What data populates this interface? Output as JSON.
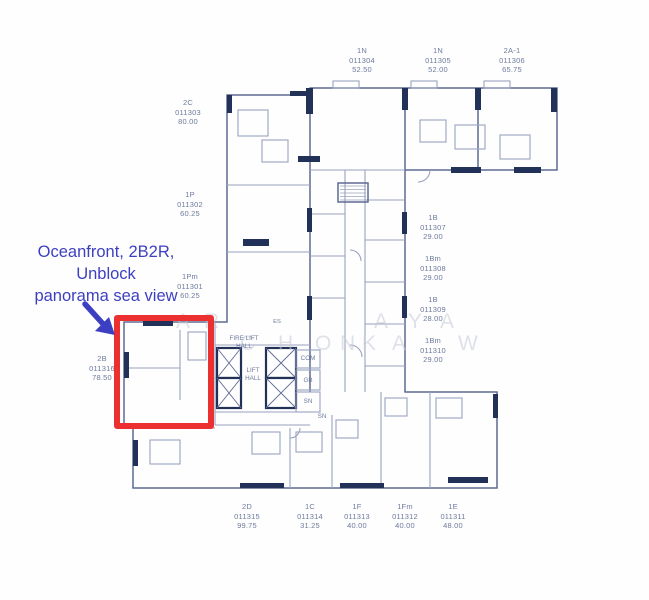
{
  "colors": {
    "red": "#ec2f2f",
    "blue": "#3d3fc2",
    "wall-dark": "#223158",
    "wall-mid": "#5e6b94",
    "wall-light": "#9aa3bf",
    "label": "#6d7a9c",
    "watermark": "#c4cad7"
  },
  "annotation": {
    "line1": "Oceanfront, 2B2R,",
    "line2": "Unblock",
    "line3": "panorama sea view"
  },
  "units": [
    {
      "id": "1N",
      "code": "011304",
      "area": "52.50"
    },
    {
      "id": "1N",
      "code": "011305",
      "area": "52.00"
    },
    {
      "id": "2A-1",
      "code": "011306",
      "area": "65.75"
    },
    {
      "id": "2C",
      "code": "011303",
      "area": "80.00"
    },
    {
      "id": "1P",
      "code": "011302",
      "area": "60.25"
    },
    {
      "id": "1Pm",
      "code": "011301",
      "area": "60.25"
    },
    {
      "id": "2B",
      "code": "011316",
      "area": "78.50"
    },
    {
      "id": "1B",
      "code": "011307",
      "area": "29.00"
    },
    {
      "id": "1Bm",
      "code": "011308",
      "area": "29.00"
    },
    {
      "id": "1B",
      "code": "011309",
      "area": "28.00"
    },
    {
      "id": "1Bm",
      "code": "011310",
      "area": "29.00"
    },
    {
      "id": "2D",
      "code": "011315",
      "area": "99.75"
    },
    {
      "id": "1C",
      "code": "011314",
      "area": "31.25"
    },
    {
      "id": "1F",
      "code": "011313",
      "area": "40.00"
    },
    {
      "id": "1Fm",
      "code": "011312",
      "area": "40.00"
    },
    {
      "id": "1E",
      "code": "011311",
      "area": "48.00"
    }
  ],
  "core_labels": {
    "fire_lift_line1": "FIRE LIFT",
    "fire_lift_line2": "HALL",
    "lift_line1": "LIFT",
    "lift_line2": "HALL",
    "com": "COM",
    "gb": "GB",
    "sn1": "SN",
    "sn2": "SN",
    "es": "ES"
  },
  "watermark": {
    "letters": [
      {
        "ch": "A"
      },
      {
        "ch": "R"
      },
      {
        "ch": "A"
      },
      {
        "ch": "Y"
      },
      {
        "ch": "A"
      },
      {
        "ch": "C"
      },
      {
        "ch": "H"
      },
      {
        "ch": "O"
      },
      {
        "ch": "N"
      },
      {
        "ch": "K"
      },
      {
        "ch": "A"
      },
      {
        "ch": "W"
      }
    ]
  }
}
